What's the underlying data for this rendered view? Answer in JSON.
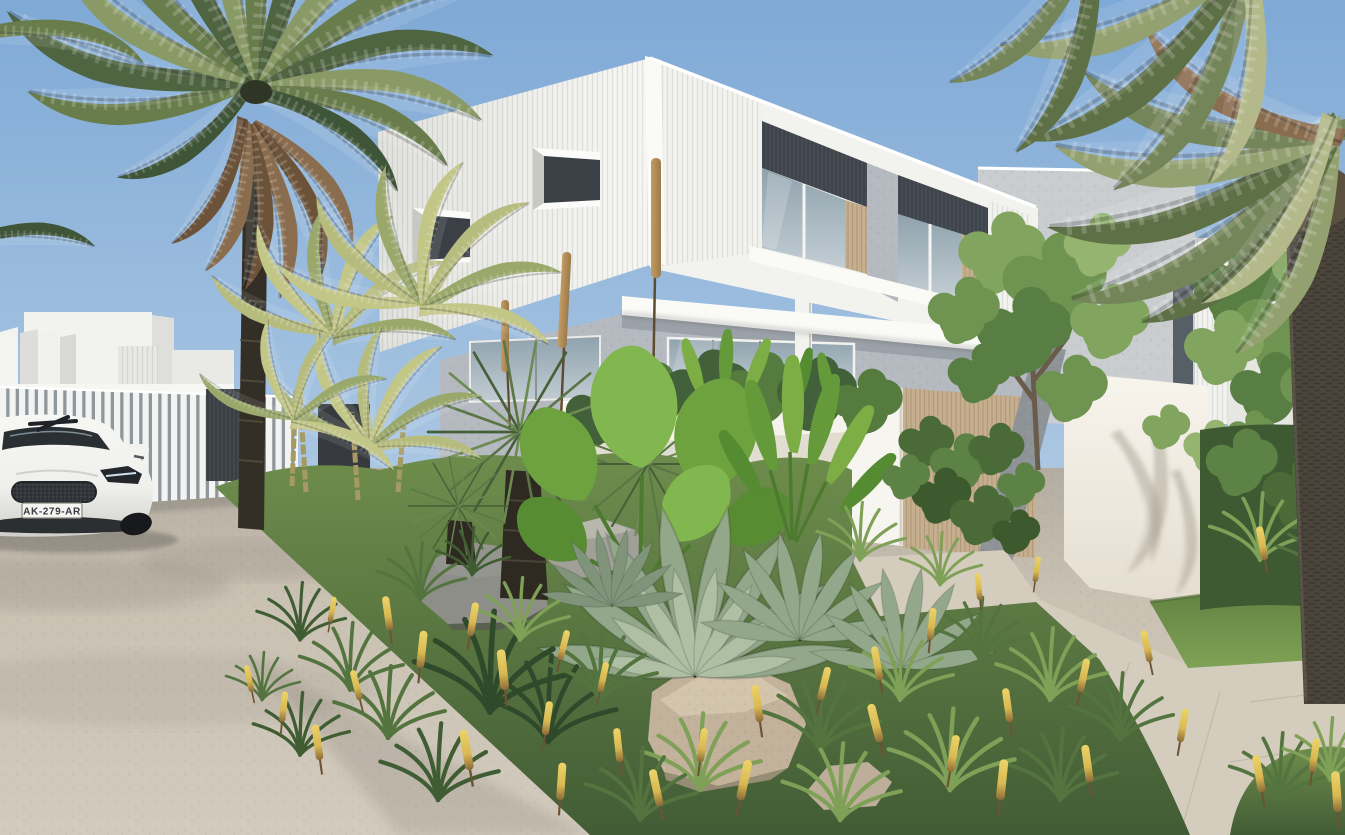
{
  "scene": {
    "type": "architectural exterior render",
    "setting": "modern white coastal townhouse development with lush tropical landscaping, viewed from the street",
    "sky": "clear blue sky, paler toward horizon",
    "car": {
      "license_plate": "AK-279-AR",
      "body_color_name": "white",
      "position": "parked at lower left on the road"
    },
    "architecture": [
      "two-storey townhouse with white vertical-ribbed cladding",
      "recessed balconies with charcoal cladding, timber battens and glass sliders",
      "grey precast-concrete ground floor with window band",
      "protruding white box windows",
      "white batten front fence with dark gate panels",
      "timber batten fence and concrete blade walls at entry",
      "neighbouring white buildings left and right"
    ],
    "landscape": [
      "large date palm on the left",
      "tall palm trunk and fronds on the right",
      "golden cane palms",
      "grass trees with tall brown flower spikes",
      "blue-green agaves",
      "grevillea shrubs with yellow flower spikes",
      "elephant-ear and strelitzia leaves",
      "grey and beige boulders",
      "strip of lawn and paved path at right",
      "beige asphalt road in foreground"
    ]
  },
  "palette": {
    "sky_top": "#7fa9d6",
    "sky_mid": "#a9c6e2",
    "sky_horizon": "#d6e4ef",
    "cladding": "#f2f2ef",
    "cladding_shade": "#dededa",
    "fascia": "#fafaf7",
    "charcoal": "#3e444b",
    "timber": "#c5af8e",
    "glass_top": "#8fa2ad",
    "glass_bottom": "#c2cdd3",
    "concrete": "#b4bac0",
    "concrete_dark": "#9ba1a8",
    "module_grey": "#c9cdd0",
    "fence_white": "#f3f4f2",
    "fence_shadow": "#8e979c",
    "gate_dark": "#3a3f44",
    "wall_white": "#f6f3ec",
    "road": "#c9c1b2",
    "road_far": "#b3aca0",
    "path": "#d4cdbe",
    "lawn": "#7ea255",
    "lawn_dark": "#5e7c3f",
    "bed_light": "#6e8d4c",
    "bed_dark": "#425c35",
    "palm_green": "#5e7346",
    "palm_light": "#93a070",
    "palm_dead": "#8a6c4e",
    "golden_palm": "#c2c687",
    "trunk_dark": "#332e26",
    "trunk_fiber": "#4c453b",
    "spike_yellow": "#d9b852",
    "poker_brown": "#9a7a4c",
    "rock_grey": "#8e8e88",
    "rock_beige": "#c2b29b",
    "agave": "#93a88a",
    "car_white": "#efefec",
    "car_glass": "#2a2f33",
    "plate_bg": "#f4f4f0",
    "plate_text": "#343a40"
  }
}
